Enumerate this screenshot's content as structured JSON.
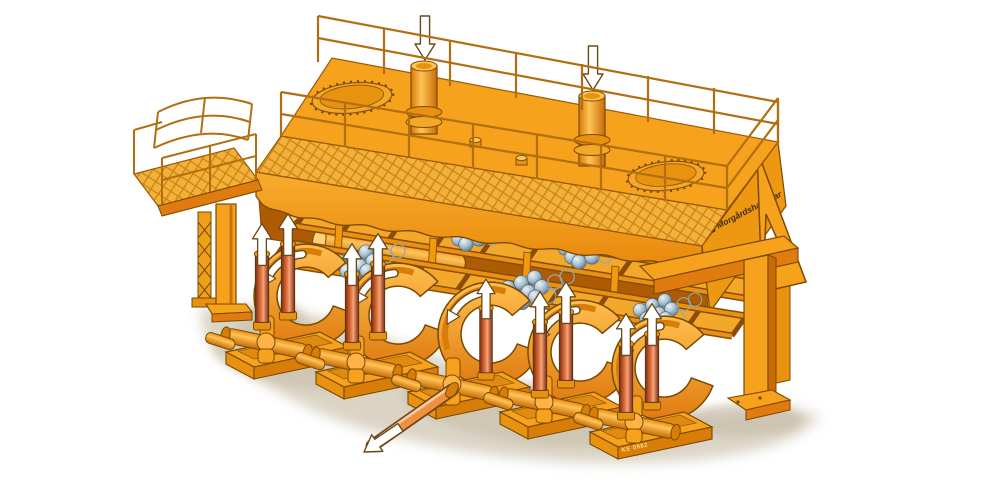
{
  "illustration": {
    "logo": {
      "text": "Morgårdshammar",
      "icon": "logo-badge-icon"
    },
    "caption": {
      "drawing_number": "KE 0982"
    },
    "annotations": {
      "inlet_arrows_down": {
        "icon": "arrow-down-icon",
        "count": 2
      },
      "lift_arrows_up": {
        "icon": "arrow-up-icon",
        "count": 7
      },
      "drum_rotation_arrows": {
        "icon": "curved-arrow-icon",
        "count": 5
      },
      "outlet_arrow": {
        "icon": "arrow-out-icon",
        "count": 1
      },
      "roller_ball_clusters": {
        "icon": "roller-balls-icon",
        "count": 6
      },
      "manholes": {
        "icon": "manhole-icon",
        "count": 2
      }
    },
    "colors": {
      "body": "#F6A21C",
      "body_light": "#FBBE4A",
      "body_dark": "#E07B10",
      "body_deep": "#C96B05",
      "cavity": "#AE5C03",
      "outline": "#7A4A00",
      "outline_dark": "#59380A",
      "mesh_line": "#C8860E",
      "mesh_bg": "#F3B13C",
      "rail": "#B26F12",
      "cyl_red": "#8E2F15",
      "cyl_red_light": "#E87940",
      "ball": "#A9C0CF",
      "ball_dark": "#6E8BA0",
      "ball_light": "#EAF2F6",
      "teal": "#2FA8B5",
      "arrow_fill": "#FFFFFF",
      "arrow_stroke": "#6B4A1A",
      "shadow": "#D5CDBC",
      "shadow_dark": "#C4BAA5",
      "text_dark": "#3B2B12",
      "caption": "#F7DF7E"
    }
  }
}
